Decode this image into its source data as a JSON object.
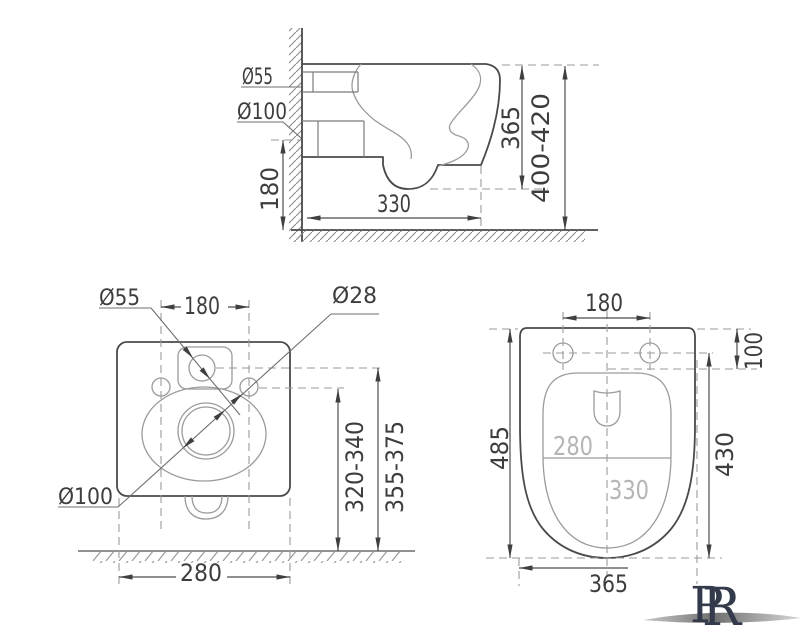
{
  "drawing": {
    "title": "wall-hung-toilet-dimension-drawing",
    "side_view": {
      "inlet_diameter": "Ø55",
      "outlet_diameter": "Ø100",
      "outlet_height": "180",
      "depth_to_wall": "330",
      "body_height": "365",
      "install_height_range": "400-420"
    },
    "rear_view": {
      "inlet_diameter": "Ø55",
      "bolt_hole_diameter": "Ø28",
      "outlet_diameter": "Ø100",
      "bolt_spacing": "180",
      "body_width": "280",
      "outlet_center_height_range": "320-340",
      "inlet_center_height_range": "355-375"
    },
    "plan_view": {
      "bolt_spacing": "180",
      "bolt_offset_from_back": "100",
      "total_length": "485",
      "bolt_to_front_length": "430",
      "bowl_width_label": "280",
      "bowl_length_label": "330",
      "total_width": "365"
    },
    "logo": {
      "letter_back": "P",
      "letter_front": "R"
    }
  },
  "colors": {
    "line": "#4a4a4a",
    "dimension": "#3d3d3d",
    "dashed": "#9a9a9a",
    "inner_gray_text": "#b5b5b5",
    "logo_navy": "#333a4c",
    "swoosh_gray": "#8f8f8f"
  }
}
